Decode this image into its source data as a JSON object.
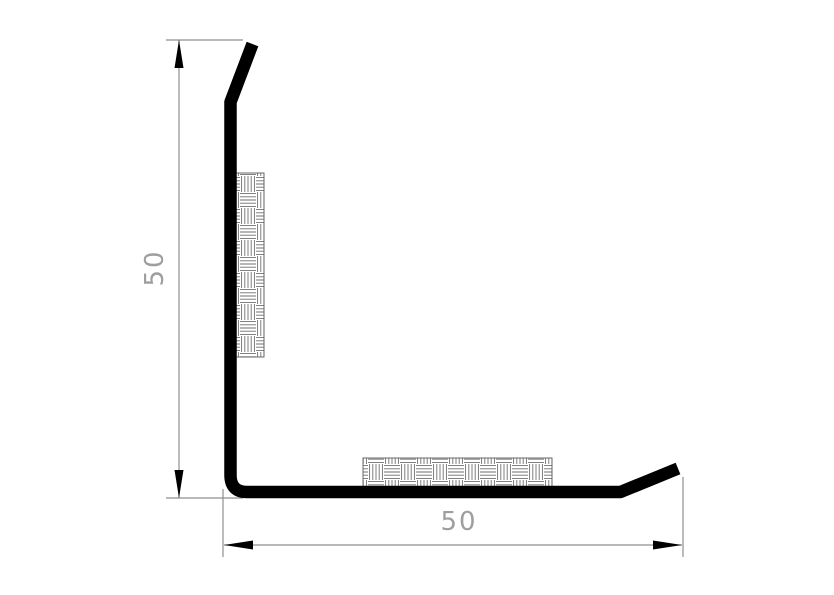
{
  "drawing": {
    "vertical_dimension": {
      "label": "50",
      "orientation": "vertical"
    },
    "horizontal_dimension": {
      "label": "50",
      "orientation": "horizontal"
    },
    "icons": {
      "dimension_arrow": "filled-triangle"
    },
    "colors": {
      "background": "#ffffff",
      "profile": "#000000",
      "dimension_line": "#8f8f8f",
      "dimension_text": "#9e9e9e",
      "hatch_line": "#6f6f6f",
      "hatch_border": "#5a5a5a"
    }
  }
}
